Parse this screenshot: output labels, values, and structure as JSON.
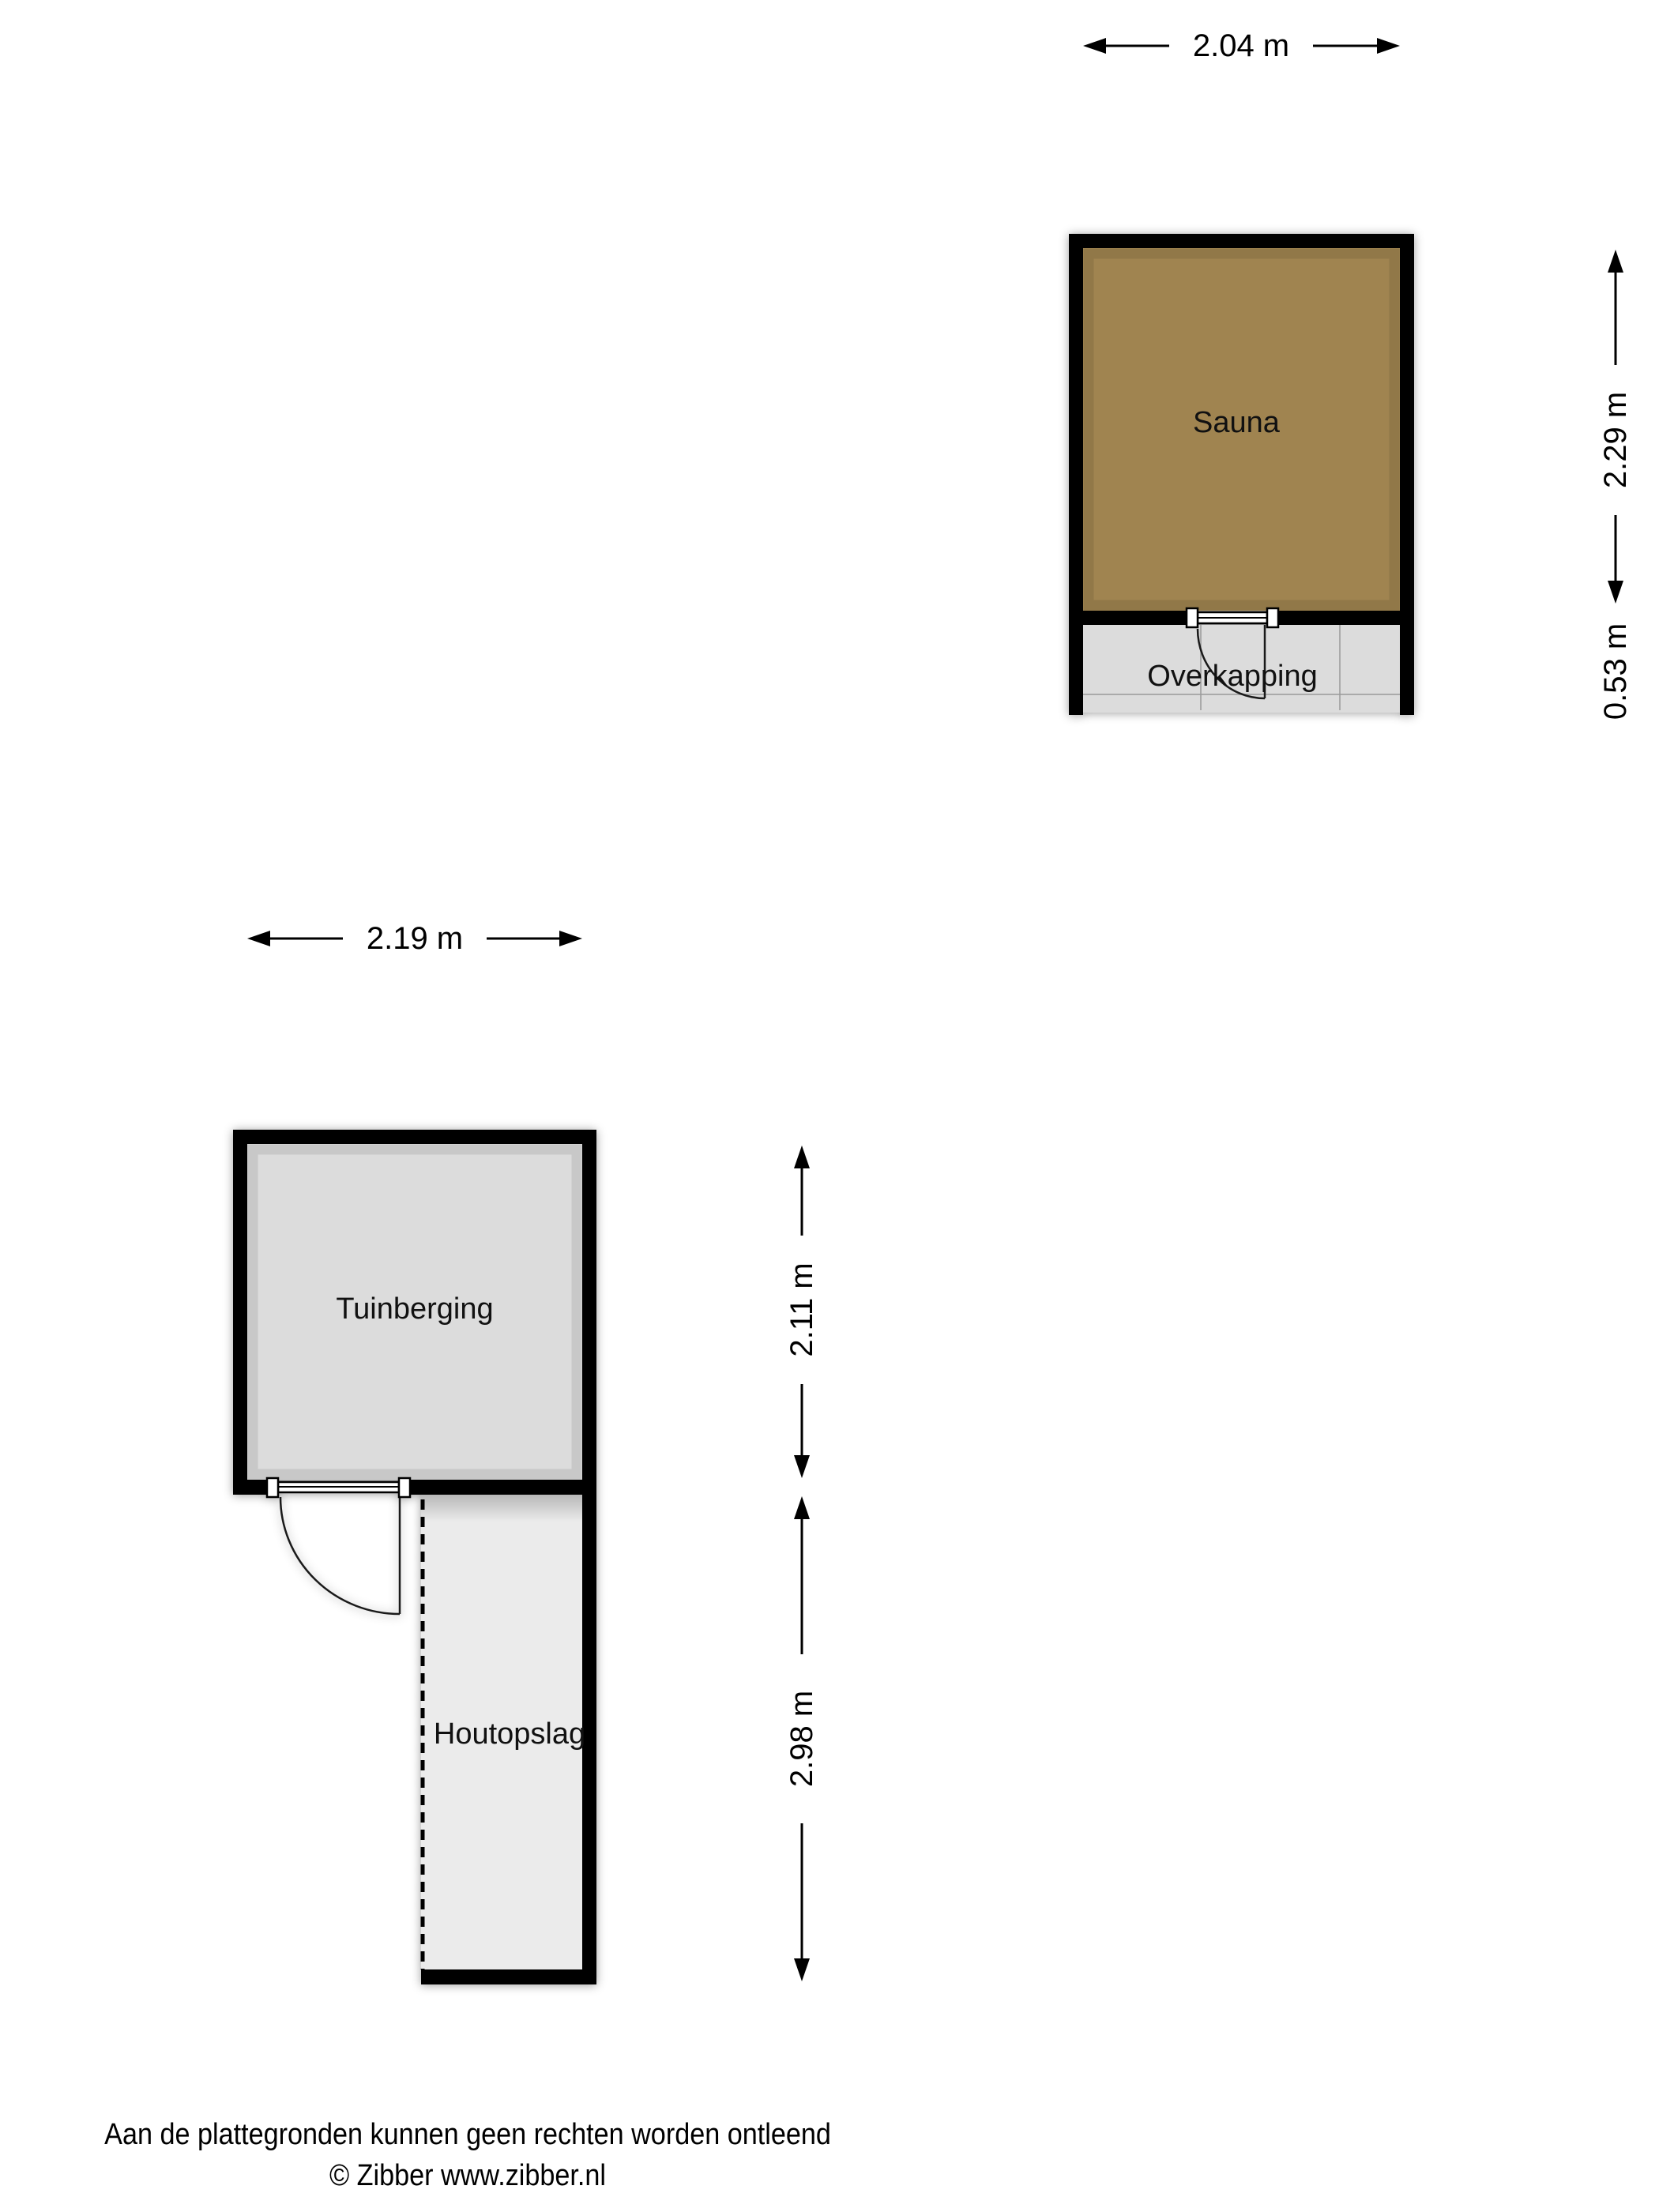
{
  "sauna_block": {
    "room_label": "Sauna",
    "overkapping_label": "Overkapping",
    "dim_width": "2.04 m",
    "dim_height": "2.29 m",
    "dim_overkapping_depth": "0.53 m"
  },
  "shed_block": {
    "room_label": "Tuinberging",
    "houtopslag_label": "Houtopslag",
    "dim_width": "2.19 m",
    "dim_height": "2.11 m",
    "dim_houtopslag_height": "2.98 m"
  },
  "footer": {
    "disclaimer": "Aan de plattegronden kunnen geen rechten worden ontleend",
    "credit": "© Zibber www.zibber.nl"
  },
  "colors": {
    "sauna_floor": "#a08450",
    "room_floor": "#dcdcdc",
    "houtopslag_floor": "#ebebeb",
    "wall": "#000000"
  }
}
